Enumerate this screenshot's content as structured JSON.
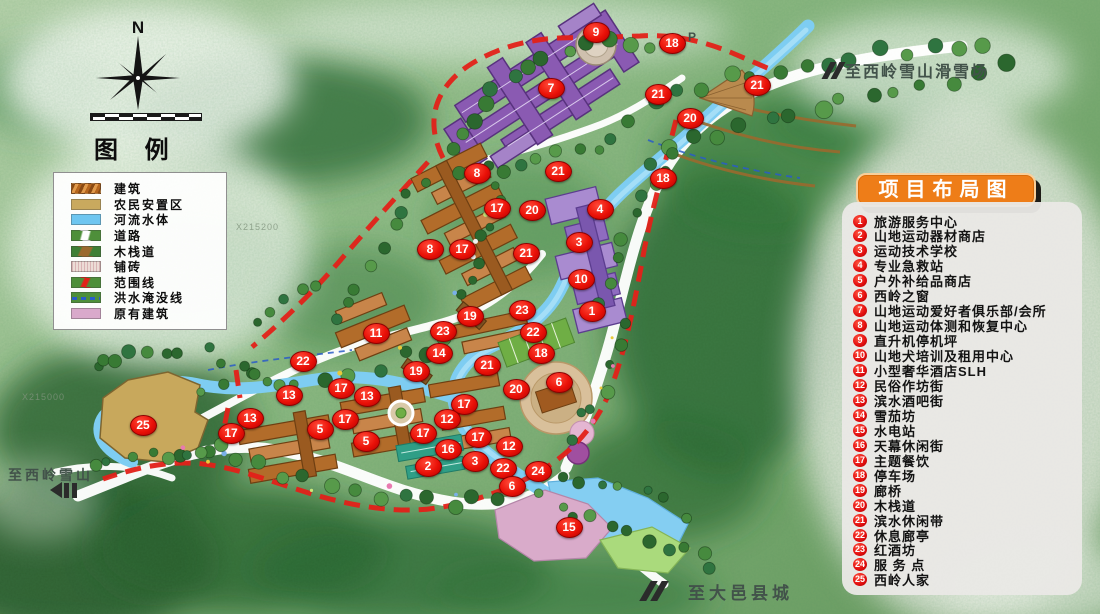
{
  "compass": {
    "north_label": "N"
  },
  "legend": {
    "title": "图 例",
    "items": [
      {
        "label": "建筑",
        "swatch": "building"
      },
      {
        "label": "农民安置区",
        "swatch": "resettlement"
      },
      {
        "label": "河流水体",
        "swatch": "water"
      },
      {
        "label": "道路",
        "swatch": "road"
      },
      {
        "label": "木栈道",
        "swatch": "boardwalk"
      },
      {
        "label": "铺砖",
        "swatch": "paving"
      },
      {
        "label": "范围线",
        "swatch": "boundary"
      },
      {
        "label": "洪水淹没线",
        "swatch": "floodline"
      },
      {
        "label": "原有建筑",
        "swatch": "existing"
      }
    ]
  },
  "panel": {
    "title": "项目布局图",
    "items": [
      {
        "n": 1,
        "label": "旅游服务中心"
      },
      {
        "n": 2,
        "label": "山地运动器材商店"
      },
      {
        "n": 3,
        "label": "运动技术学校"
      },
      {
        "n": 4,
        "label": "专业急救站"
      },
      {
        "n": 5,
        "label": "户外补给品商店"
      },
      {
        "n": 6,
        "label": "西岭之窗"
      },
      {
        "n": 7,
        "label": "山地运动爱好者俱乐部/会所"
      },
      {
        "n": 8,
        "label": "山地运动体测和恢复中心"
      },
      {
        "n": 9,
        "label": "直升机停机坪"
      },
      {
        "n": 10,
        "label": "山地犬培训及租用中心"
      },
      {
        "n": 11,
        "label": "小型奢华酒店SLH"
      },
      {
        "n": 12,
        "label": "民俗作坊街"
      },
      {
        "n": 13,
        "label": "滨水酒吧街"
      },
      {
        "n": 14,
        "label": "雪茄坊"
      },
      {
        "n": 15,
        "label": "水电站"
      },
      {
        "n": 16,
        "label": "天幕休闲街"
      },
      {
        "n": 17,
        "label": "主题餐饮"
      },
      {
        "n": 18,
        "label": "停车场"
      },
      {
        "n": 19,
        "label": "廊桥"
      },
      {
        "n": 20,
        "label": "木栈道"
      },
      {
        "n": 21,
        "label": "滨水休闲带"
      },
      {
        "n": 22,
        "label": "休息廊亭"
      },
      {
        "n": 23,
        "label": "红酒坊"
      },
      {
        "n": 24,
        "label": "服 务 点"
      },
      {
        "n": 25,
        "label": "西岭人家"
      }
    ]
  },
  "map_labels": [
    {
      "id": "ski-resort",
      "text": "至西岭雪山滑雪场",
      "x": 845,
      "y": 58,
      "size": 16,
      "ls": 2
    },
    {
      "id": "xiling",
      "text": "至西岭雪山",
      "x": 8,
      "y": 465,
      "size": 14,
      "ls": 3
    },
    {
      "id": "dayi",
      "text": "至大邑县城",
      "x": 688,
      "y": 579,
      "size": 17,
      "ls": 4
    },
    {
      "id": "parking-p",
      "text": "P",
      "x": 688,
      "y": 30,
      "size": 12,
      "ls": 0
    }
  ],
  "grid_labels": [
    {
      "text": "X215000",
      "x": 22,
      "y": 392
    },
    {
      "text": "X215200",
      "x": 236,
      "y": 222
    }
  ],
  "markers": [
    {
      "n": 9,
      "x": 596,
      "y": 32
    },
    {
      "n": 18,
      "x": 672,
      "y": 43
    },
    {
      "n": 7,
      "x": 551,
      "y": 88
    },
    {
      "n": 21,
      "x": 658,
      "y": 94
    },
    {
      "n": 21,
      "x": 757,
      "y": 85
    },
    {
      "n": 20,
      "x": 690,
      "y": 118
    },
    {
      "n": 8,
      "x": 477,
      "y": 173
    },
    {
      "n": 21,
      "x": 558,
      "y": 171
    },
    {
      "n": 18,
      "x": 663,
      "y": 178
    },
    {
      "n": 17,
      "x": 497,
      "y": 208
    },
    {
      "n": 20,
      "x": 532,
      "y": 210
    },
    {
      "n": 4,
      "x": 600,
      "y": 209
    },
    {
      "n": 3,
      "x": 579,
      "y": 242
    },
    {
      "n": 8,
      "x": 430,
      "y": 249
    },
    {
      "n": 17,
      "x": 462,
      "y": 249
    },
    {
      "n": 21,
      "x": 526,
      "y": 253
    },
    {
      "n": 10,
      "x": 581,
      "y": 279
    },
    {
      "n": 1,
      "x": 592,
      "y": 311
    },
    {
      "n": 19,
      "x": 470,
      "y": 316
    },
    {
      "n": 23,
      "x": 522,
      "y": 310
    },
    {
      "n": 23,
      "x": 443,
      "y": 331
    },
    {
      "n": 11,
      "x": 376,
      "y": 333
    },
    {
      "n": 22,
      "x": 533,
      "y": 332
    },
    {
      "n": 14,
      "x": 439,
      "y": 353
    },
    {
      "n": 18,
      "x": 541,
      "y": 353
    },
    {
      "n": 22,
      "x": 303,
      "y": 361
    },
    {
      "n": 19,
      "x": 416,
      "y": 371
    },
    {
      "n": 21,
      "x": 487,
      "y": 365
    },
    {
      "n": 20,
      "x": 516,
      "y": 389
    },
    {
      "n": 6,
      "x": 559,
      "y": 382
    },
    {
      "n": 13,
      "x": 289,
      "y": 395
    },
    {
      "n": 17,
      "x": 341,
      "y": 388
    },
    {
      "n": 13,
      "x": 367,
      "y": 396
    },
    {
      "n": 13,
      "x": 250,
      "y": 418
    },
    {
      "n": 17,
      "x": 231,
      "y": 433
    },
    {
      "n": 17,
      "x": 345,
      "y": 419
    },
    {
      "n": 5,
      "x": 320,
      "y": 429
    },
    {
      "n": 5,
      "x": 366,
      "y": 441
    },
    {
      "n": 17,
      "x": 464,
      "y": 404
    },
    {
      "n": 12,
      "x": 447,
      "y": 419
    },
    {
      "n": 17,
      "x": 423,
      "y": 433
    },
    {
      "n": 17,
      "x": 478,
      "y": 437
    },
    {
      "n": 16,
      "x": 448,
      "y": 449
    },
    {
      "n": 12,
      "x": 509,
      "y": 446
    },
    {
      "n": 2,
      "x": 428,
      "y": 466
    },
    {
      "n": 3,
      "x": 475,
      "y": 461
    },
    {
      "n": 22,
      "x": 503,
      "y": 468
    },
    {
      "n": 24,
      "x": 538,
      "y": 471
    },
    {
      "n": 6,
      "x": 512,
      "y": 486
    },
    {
      "n": 15,
      "x": 569,
      "y": 527
    },
    {
      "n": 25,
      "x": 143,
      "y": 425
    }
  ],
  "colors": {
    "marker_red": "#e8100c",
    "panel_orange": "#ee7d18",
    "boundary_red": "#e32119",
    "river_blue": "#7ecdf2"
  }
}
